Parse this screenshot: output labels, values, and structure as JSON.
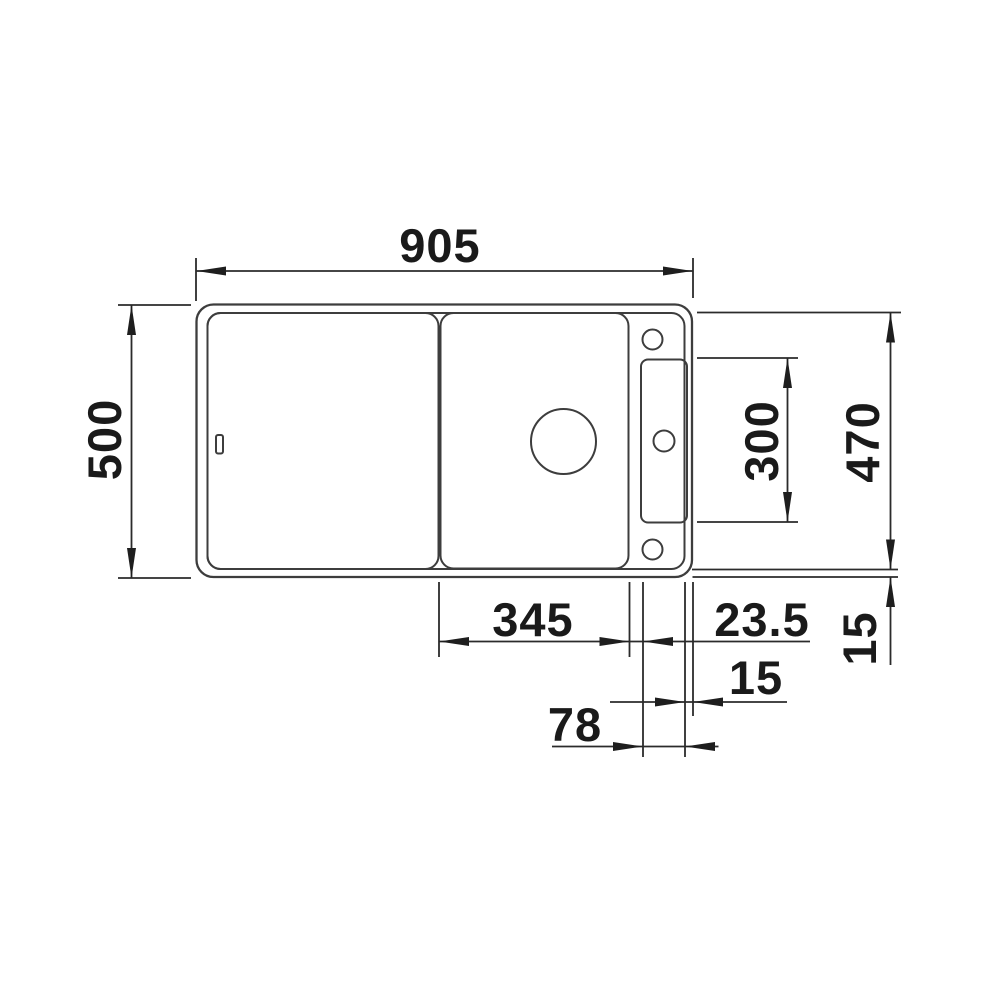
{
  "drawing": {
    "title": "Kitchen sink technical dimension drawing (top view)",
    "units": "mm",
    "colors": {
      "background": "#ffffff",
      "geometry_line": "#3d3d3d",
      "dimension_line": "#2b2b2b",
      "text": "#1a1a1a"
    },
    "dimensions": {
      "overall_width": "905",
      "overall_depth": "500",
      "inner_depth": "470",
      "tap_ledge_length": "300",
      "board_section_width": "345",
      "board_to_ledge_gap": "23.5",
      "ledge_to_edge": "15",
      "bottom_rim": "15",
      "ledge_width": "78"
    },
    "features": [
      "outer-sink-outline",
      "inner-rim-outline",
      "drainboard-section",
      "cutting-board-section",
      "tap-ledge",
      "tap-hole-top",
      "tap-hole-middle",
      "tap-hole-bottom",
      "drain-hole",
      "overflow-slot"
    ]
  }
}
